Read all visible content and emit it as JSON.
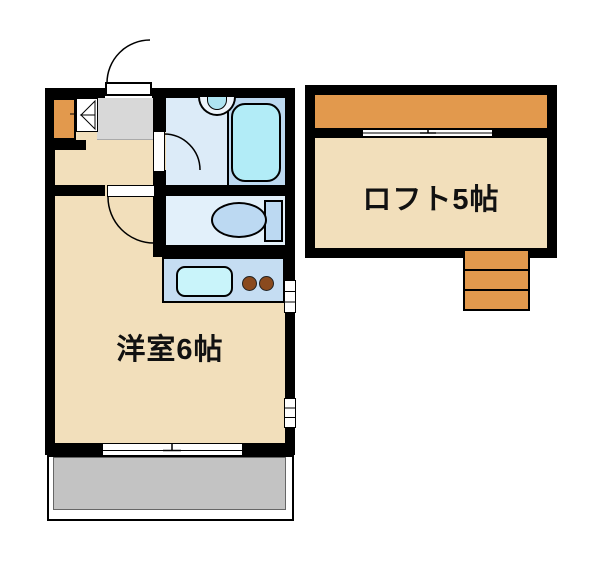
{
  "floorplan": {
    "rooms": {
      "main_room": {
        "label": "洋室6帖",
        "type": "western-style-room",
        "size_tatami": 6
      },
      "loft": {
        "label": "ロフト5帖",
        "type": "loft",
        "size_tatami": 5
      }
    },
    "fixtures": [
      {
        "name": "entrance-door-icon",
        "kind": "swing-door"
      },
      {
        "name": "shoe-cabinet-icon",
        "kind": "storage"
      },
      {
        "name": "folding-door-icon",
        "kind": "bifold-door"
      },
      {
        "name": "washbasin-icon",
        "kind": "basin"
      },
      {
        "name": "bathtub-icon",
        "kind": "bathtub"
      },
      {
        "name": "toilet-icon",
        "kind": "toilet"
      },
      {
        "name": "kitchen-sink-icon",
        "kind": "sink"
      },
      {
        "name": "stove-burners-icon",
        "kind": "two-burner-stove",
        "count": 2
      },
      {
        "name": "room-door-icon",
        "kind": "swing-door"
      },
      {
        "name": "bathroom-door-icon",
        "kind": "swing-door"
      },
      {
        "name": "sliding-window-icon",
        "kind": "sliding-window"
      },
      {
        "name": "side-window-icon",
        "kind": "casement-window",
        "count": 2
      },
      {
        "name": "loft-window-icon",
        "kind": "sliding-window"
      },
      {
        "name": "balcony",
        "kind": "balcony"
      },
      {
        "name": "stairs-icon",
        "kind": "loft-steps",
        "steps": 3
      }
    ],
    "colors": {
      "wall": "#000000",
      "floor_beige": "#f2dfbb",
      "genkan_gray": "#d8d8d8",
      "balcony_gray": "#c3c3c3",
      "accent_orange": "#e2994d",
      "bathroom_floor_blue": "#dcebf8",
      "bath_surround_blue": "#bdd9f0",
      "bathtub_cyan": "#b2ecf7",
      "toilet_fixture_blue": "#bcd9f2",
      "kitchen_counter_blue": "#c5ddf2",
      "sink_cyan": "#c9f4fa",
      "burner_brown": "#8a4a1e"
    }
  }
}
